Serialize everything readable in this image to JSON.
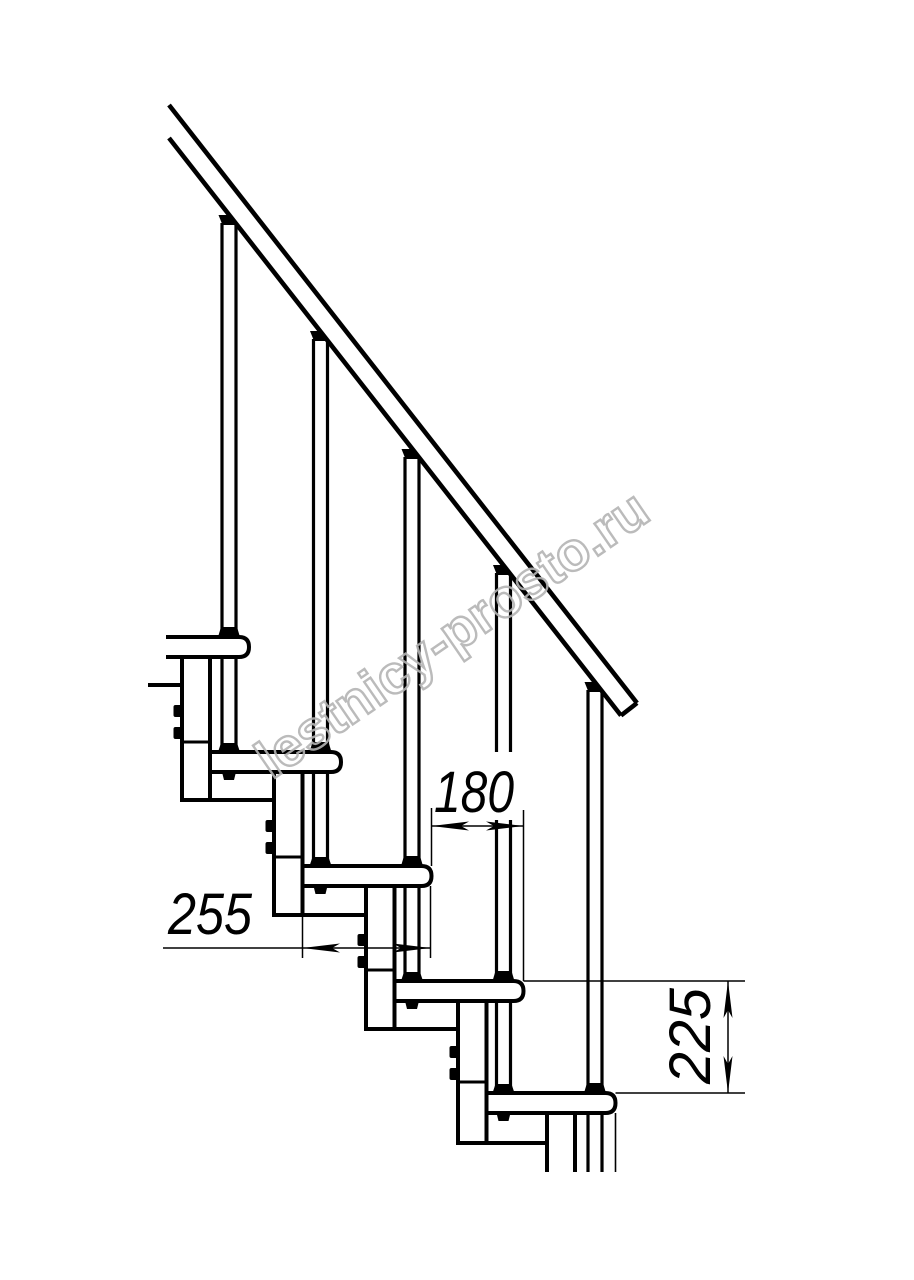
{
  "page": {
    "background": "#ffffff",
    "line_color": "#000000"
  },
  "watermark": {
    "text": "lestnicy-prosto.ru",
    "color": "#b4b4b4"
  },
  "dimensions": {
    "going": {
      "value": "180",
      "orientation": "horizontal",
      "measures": "horizontal offset between tread noses"
    },
    "tread_depth": {
      "value": "255",
      "orientation": "horizontal",
      "measures": "tread depth"
    },
    "rise": {
      "value": "225",
      "orientation": "vertical",
      "measures": "step rise"
    }
  },
  "drawing": {
    "subject": "modular staircase side elevation",
    "tread_count": 5,
    "baluster_count": 5
  }
}
